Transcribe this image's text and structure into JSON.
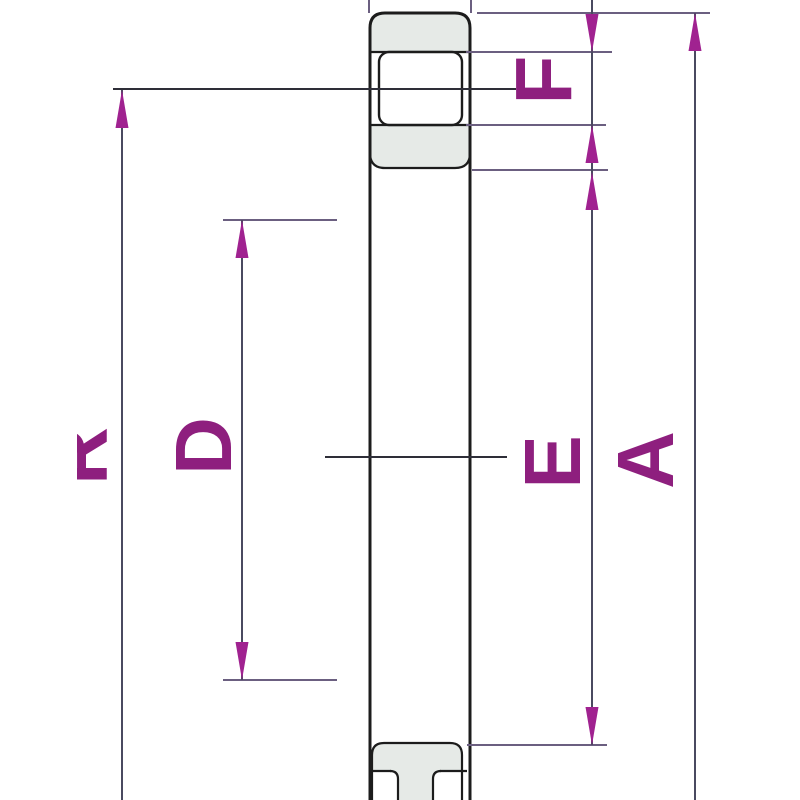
{
  "drawing": {
    "labels": {
      "f": "F",
      "d": "D",
      "e": "E",
      "a": "A",
      "partial_left": "R"
    },
    "colors": {
      "background": "#ffffff",
      "outline": "#1c1c1c",
      "shade": "#e6eae7",
      "label": "#8e1f7e",
      "arrow": "#a02290",
      "dim_line": "#4a4a60",
      "ext_line": "#6b5f80"
    }
  }
}
